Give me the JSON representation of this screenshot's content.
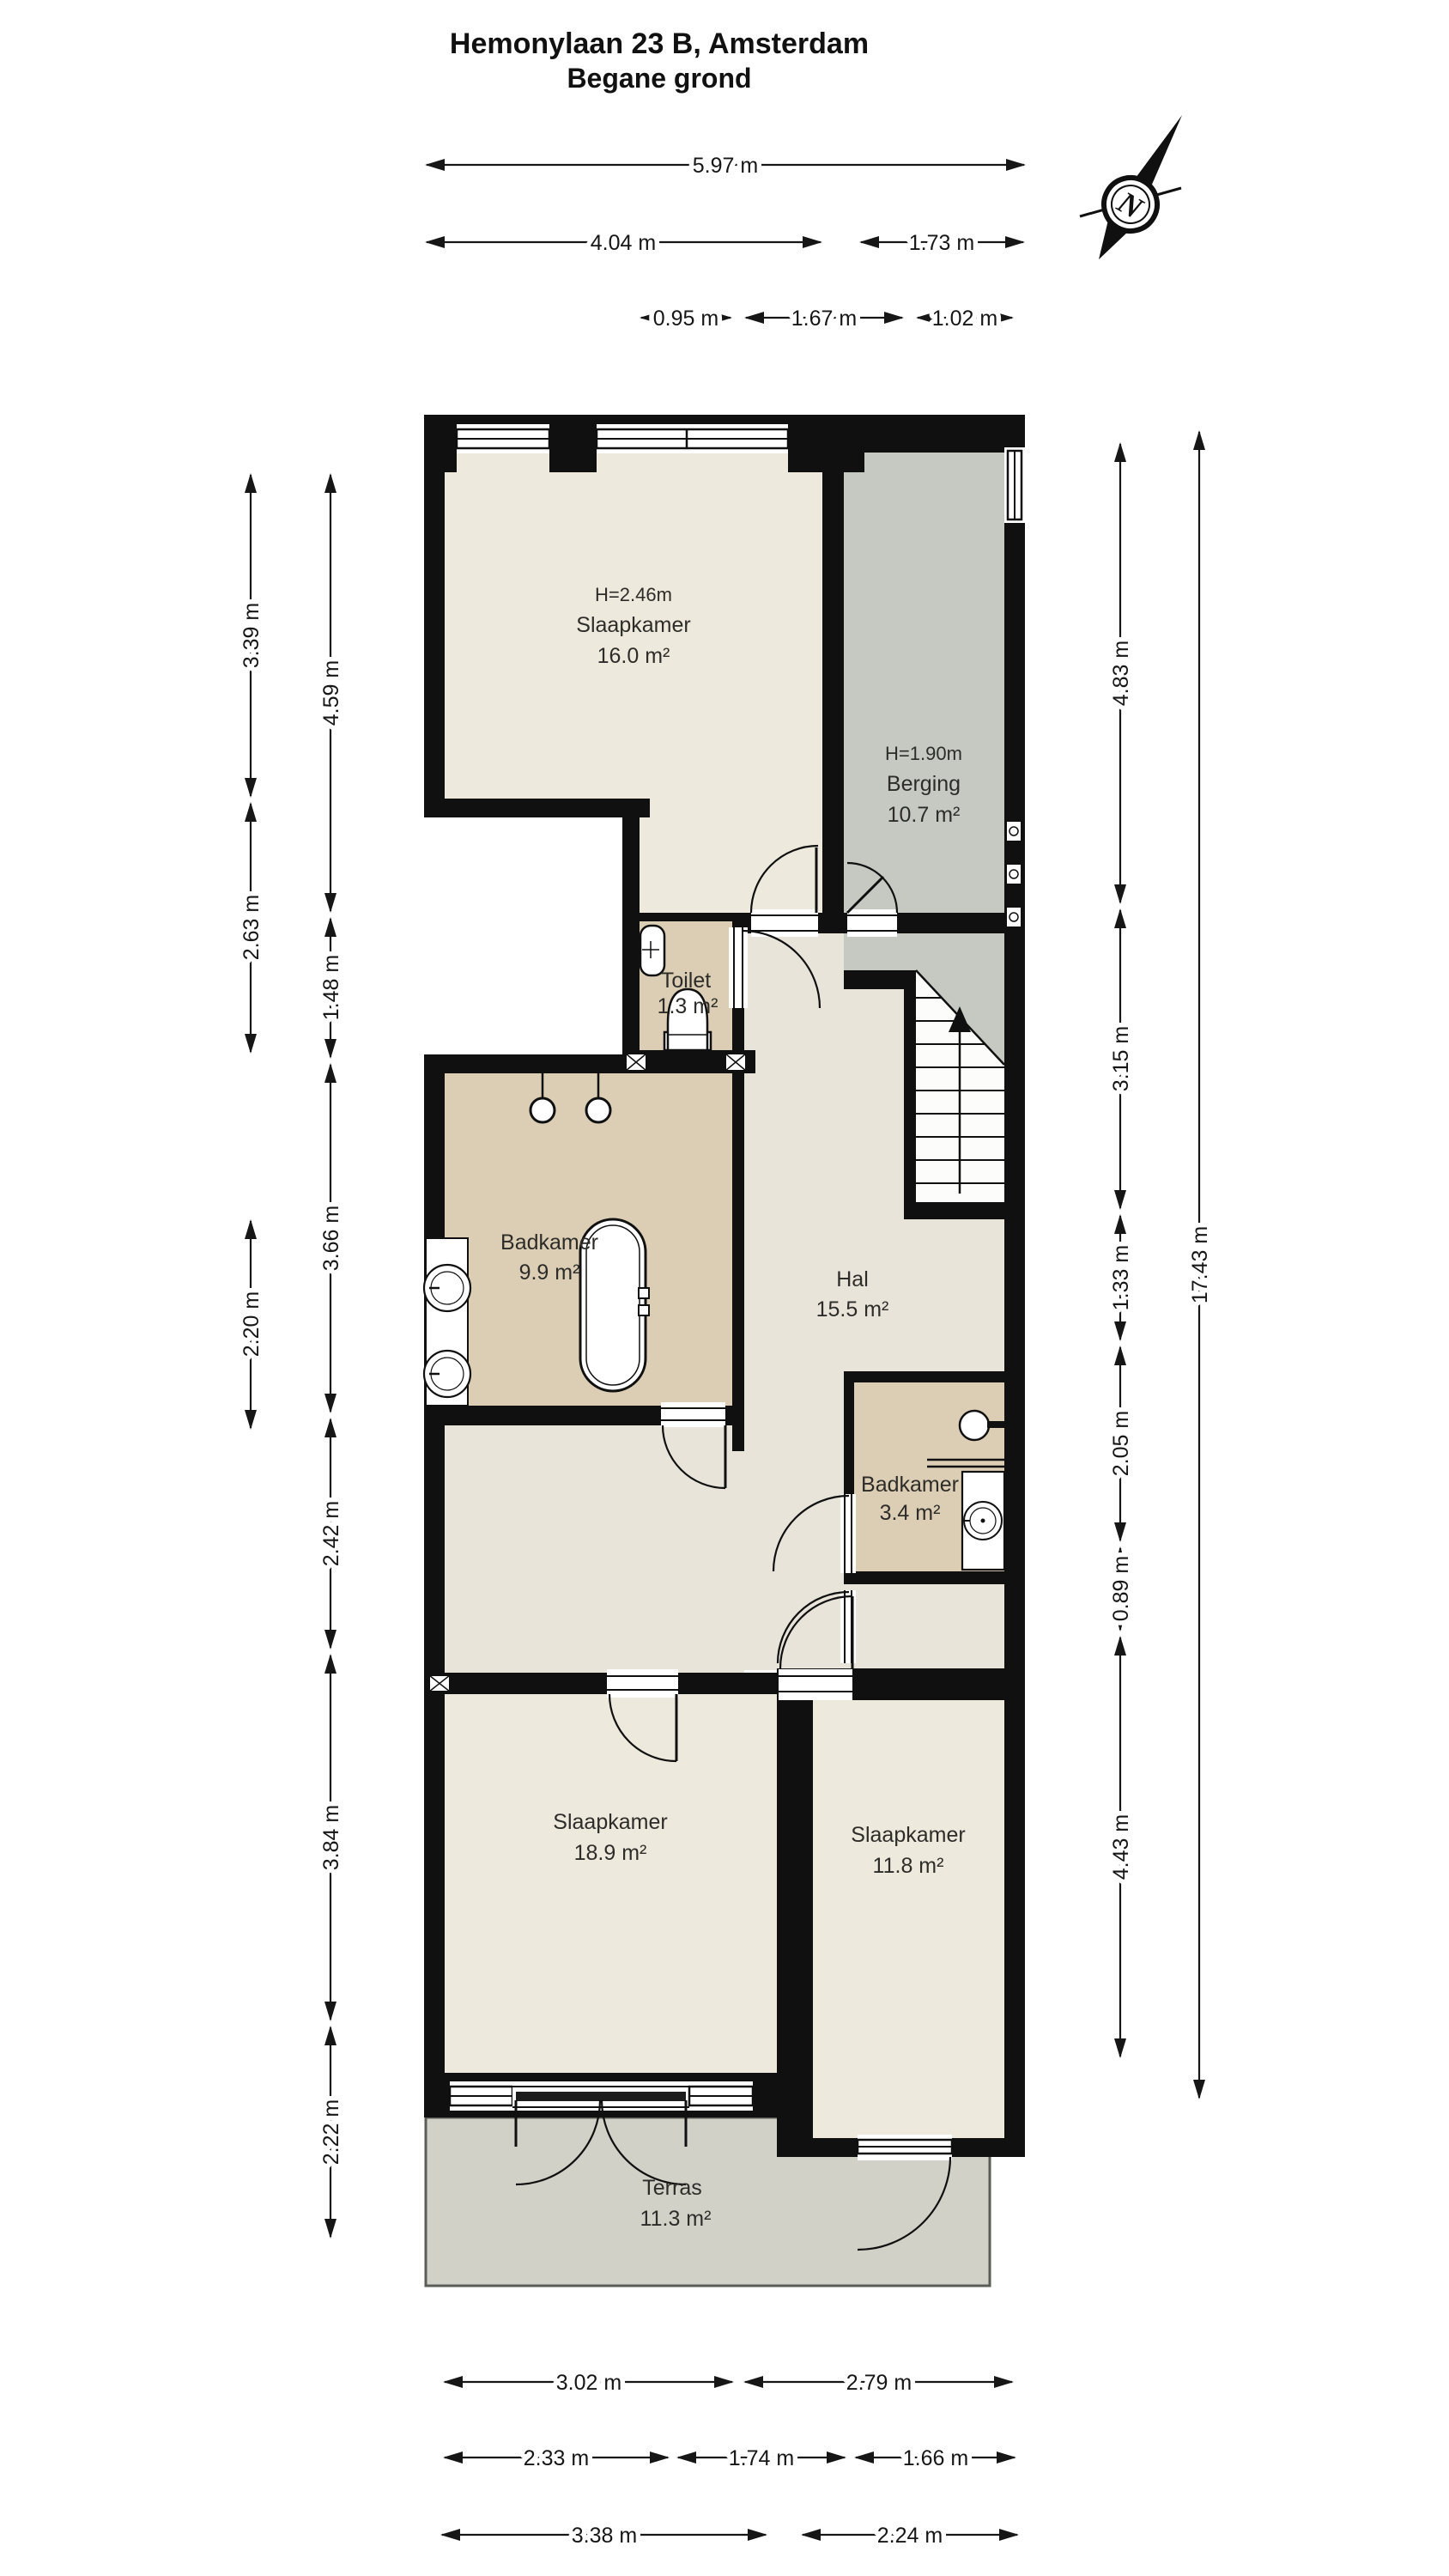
{
  "title": {
    "line1": "Hemonylaan 23 B, Amsterdam",
    "line2": "Begane grond"
  },
  "compass": {
    "label": "N"
  },
  "rooms": [
    {
      "id": "slaapkamer-16",
      "height_note": "H=2.46m",
      "name": "Slaapkamer",
      "area": "16.0 m²"
    },
    {
      "id": "berging",
      "height_note": "H=1.90m",
      "name": "Berging",
      "area": "10.7 m²"
    },
    {
      "id": "toilet",
      "name": "Toilet",
      "area": "1.3 m²"
    },
    {
      "id": "badkamer-groot",
      "name": "Badkamer",
      "area": "9.9 m²"
    },
    {
      "id": "hal",
      "name": "Hal",
      "area": "15.5 m²"
    },
    {
      "id": "badkamer-klein",
      "name": "Badkamer",
      "area": "3.4 m²"
    },
    {
      "id": "slaapkamer-189",
      "name": "Slaapkamer",
      "area": "18.9 m²"
    },
    {
      "id": "slaapkamer-118",
      "name": "Slaapkamer",
      "area": "11.8 m²"
    },
    {
      "id": "terras",
      "name": "Terras",
      "area": "11.3 m²"
    }
  ],
  "dimensions": {
    "top": [
      "5.97 m",
      "4.04 m",
      "1.73 m",
      "0.95 m",
      "1.67 m",
      "1.02 m"
    ],
    "left_outer": [
      "3.39 m",
      "2.63 m",
      "2.20 m"
    ],
    "left_inner": [
      "4.59 m",
      "1.48 m",
      "3.66 m",
      "2.42 m",
      "3.84 m",
      "2.22 m"
    ],
    "right_inner": [
      "4.83 m",
      "3.15 m",
      "1.33 m",
      "2.05 m",
      "0.89 m",
      "4.43 m"
    ],
    "right_outer": [
      "17.43 m"
    ],
    "bottom_row1": [
      "3.02 m",
      "2.79 m"
    ],
    "bottom_row2": [
      "2.33 m",
      "1.74 m",
      "1.66 m"
    ],
    "bottom_row3": [
      "3.38 m",
      "2.24 m"
    ]
  },
  "colors": {
    "wall": "#101010",
    "bedroom_floor": "#ede9dc",
    "berging_floor": "#c6c9c2",
    "bath_floor": "#dbceb4",
    "hal_floor": "#e8e4da",
    "terras_floor": "#d2d1c7"
  }
}
